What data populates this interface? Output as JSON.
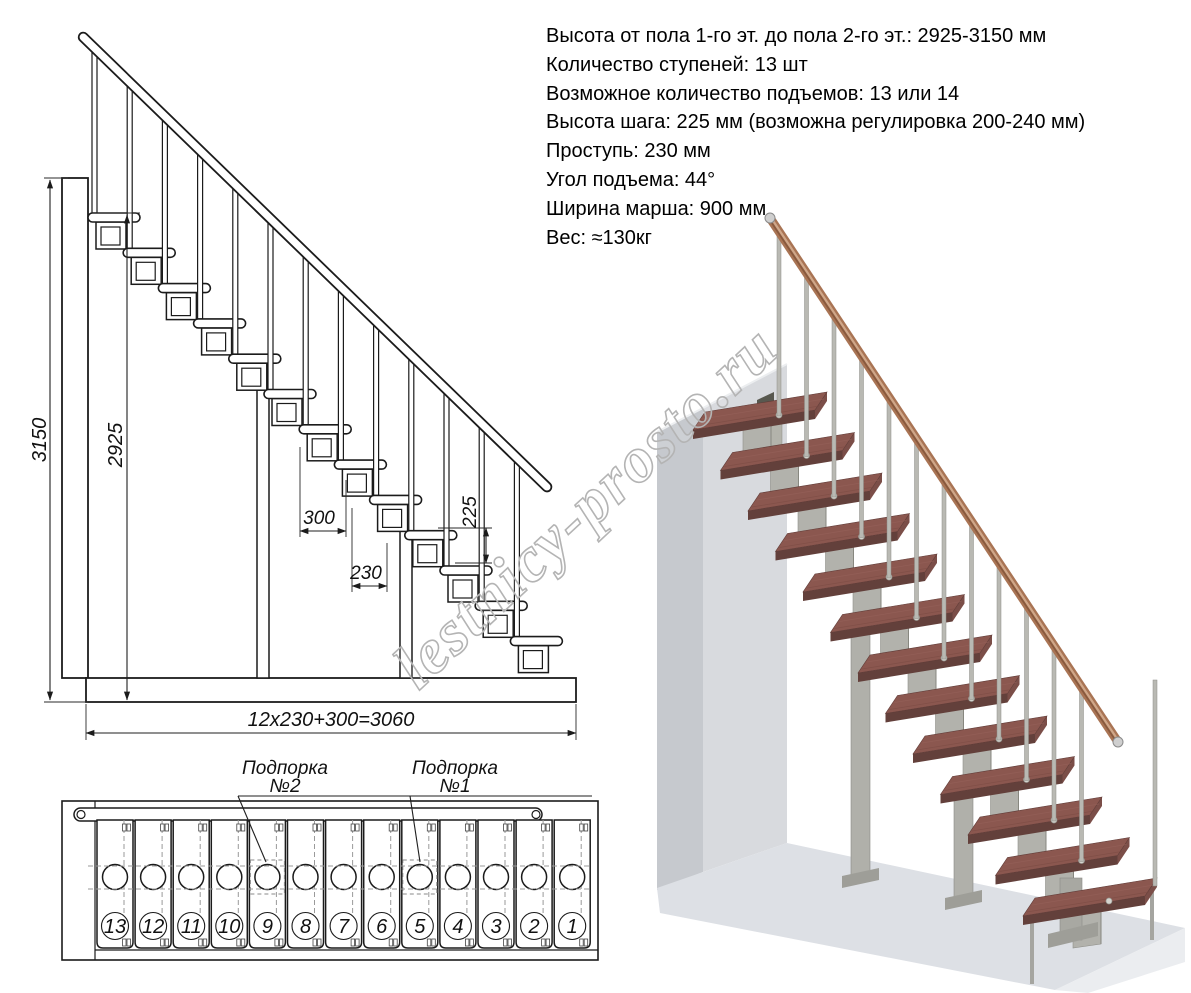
{
  "specs": {
    "lines": [
      "Высота от пола 1-го эт. до пола 2-го эт.: 2925-3150 мм",
      "Количество ступеней: 13 шт",
      "Возможное количество подъемов: 13 или 14",
      "Высота шага: 225 мм (возможна регулировка 200-240 мм)",
      "Проступь: 230 мм",
      "Угол подъема: 44°",
      "Ширина марша: 900 мм",
      "Вес: ≈130кг"
    ]
  },
  "side_view": {
    "dims": {
      "total_height": "3150",
      "floor_height": "2925",
      "platform_depth": "300",
      "tread_depth": "230",
      "step_height": "225",
      "total_run": "12x230+300=3060"
    }
  },
  "plan_view": {
    "support_labels": [
      {
        "name": "Подпорка",
        "number": "№2"
      },
      {
        "name": "Подпорка",
        "number": "№1"
      }
    ],
    "step_numbers": [
      "13",
      "12",
      "11",
      "10",
      "9",
      "8",
      "7",
      "6",
      "5",
      "4",
      "3",
      "2",
      "1"
    ]
  },
  "watermark": {
    "text": "lestnicy-prosto.ru"
  },
  "render_3d": {
    "tread_color": "#8b574f",
    "metal_color": "#b2b2ac",
    "handrail_color": "#a97454",
    "wall_color": "#d8dade",
    "floor_color": "#dde0e5"
  }
}
